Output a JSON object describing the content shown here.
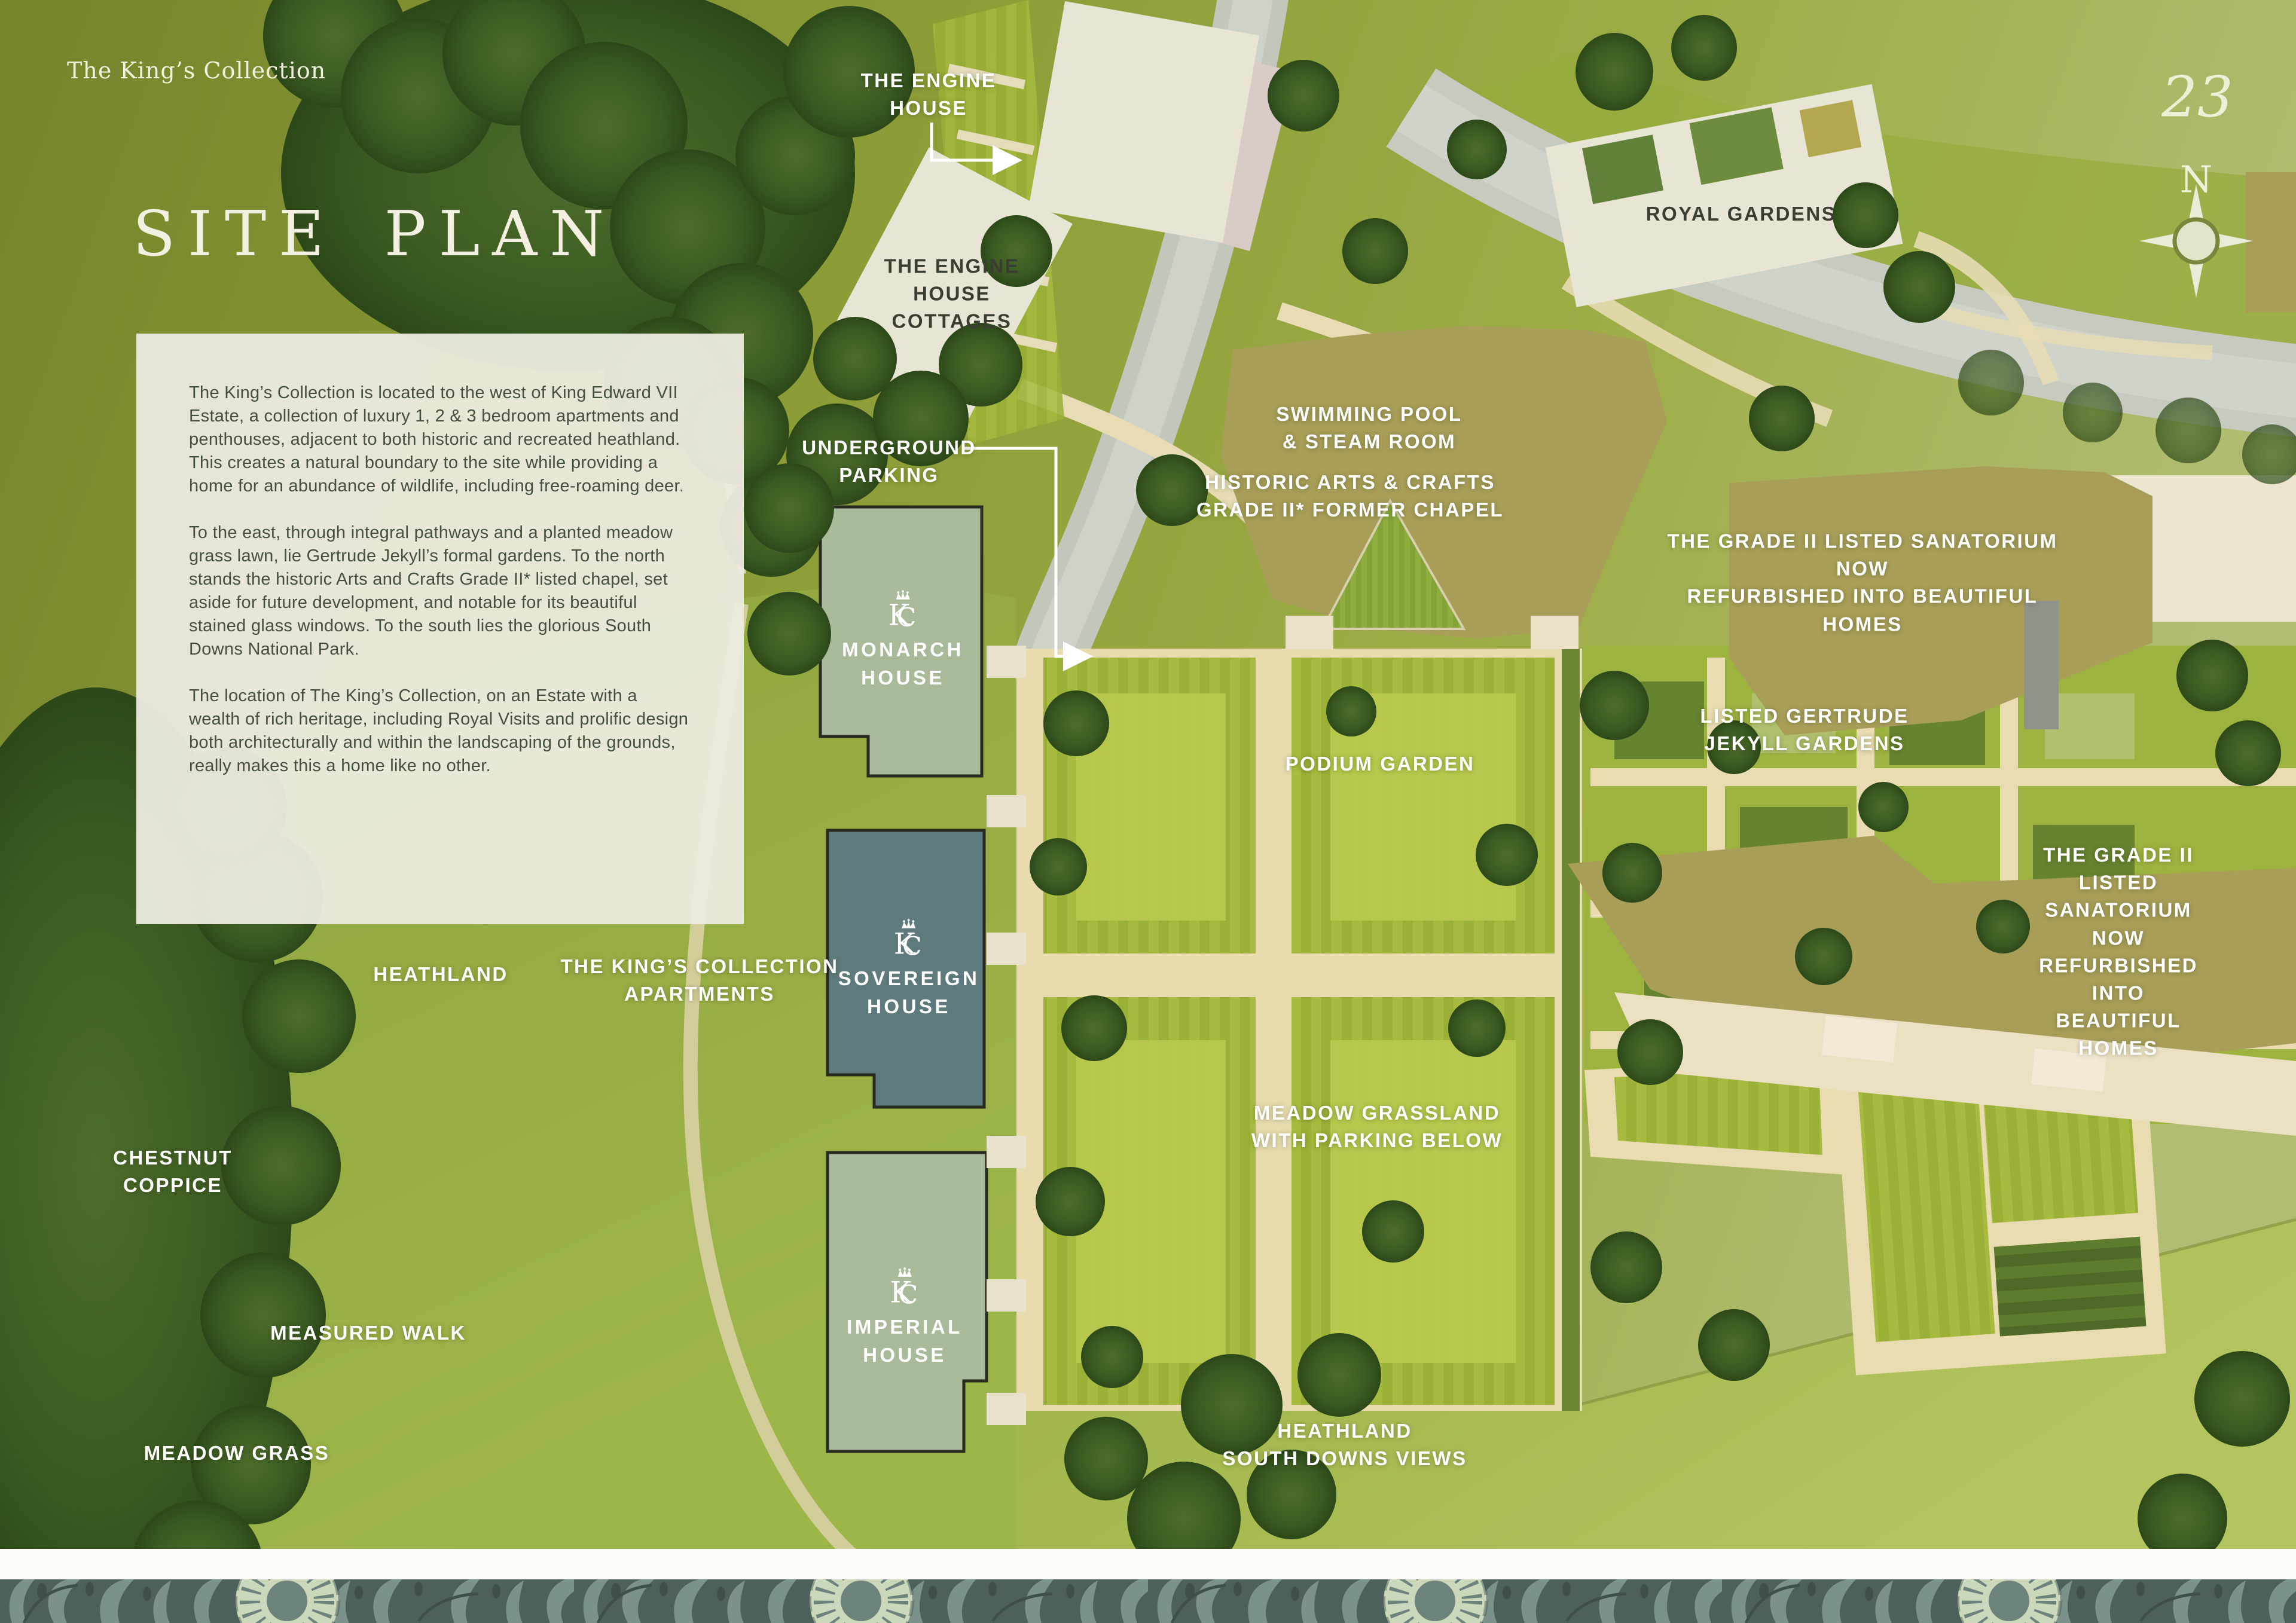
{
  "page": {
    "brand": "The King’s Collection",
    "title": "SITE PLAN",
    "page_number": "23",
    "compass": "N"
  },
  "intro": {
    "p1": "The King’s Collection is located to the west of King Edward VII Estate, a collection of luxury 1, 2 & 3 bedroom apartments and penthouses, adjacent to both historic and recreated heathland. This creates a natural boundary to the site while providing a home for an abundance of wildlife, including free-roaming deer.",
    "p2": "To the east, through integral pathways and a planted meadow grass lawn, lie Gertrude Jekyll’s formal gardens. To the north stands the historic Arts and Crafts Grade II* listed chapel, set aside for future development, and notable for its beautiful stained glass windows. To the south lies the glorious South Downs National Park.",
    "p3": "The location of The King’s Collection, on an Estate with a wealth of rich heritage, including Royal Visits and prolific design both architecturally and within the landscaping of the grounds, really makes this a home like no other."
  },
  "labels": {
    "engine_house": "THE ENGINE\nHOUSE",
    "engine_house_cottages": "THE ENGINE\nHOUSE\nCOTTAGES",
    "royal_gardens": "ROYAL GARDENS",
    "underground_parking": "UNDERGROUND\nPARKING",
    "swimming_pool": "SWIMMING POOL\n& STEAM ROOM",
    "former_chapel": "HISTORIC ARTS & CRAFTS\nGRADE II* FORMER CHAPEL",
    "sanatorium_north": "THE GRADE II LISTED SANATORIUM NOW\nREFURBISHED INTO BEAUTIFUL HOMES",
    "jekyll_gardens": "LISTED GERTRUDE\nJEKYLL GARDENS",
    "sanatorium_east": "THE GRADE II LISTED SANATORIUM NOW\nREFURBISHED INTO BEAUTIFUL HOMES",
    "podium_garden": "PODIUM GARDEN",
    "meadow_grassland": "MEADOW GRASSLAND\nWITH PARKING BELOW",
    "heathland": "HEATHLAND",
    "kings_collection_apartments": "THE KING’S COLLECTION\nAPARTMENTS",
    "chestnut_coppice": "CHESTNUT\nCOPPICE",
    "measured_walk": "MEASURED WALK",
    "meadow_grass": "MEADOW GRASS",
    "heathland_south_downs": "HEATHLAND\nSOUTH DOWNS VIEWS"
  },
  "houses": {
    "monarch": "MONARCH\nHOUSE",
    "sovereign": "SOVEREIGN\nHOUSE",
    "imperial": "IMPERIAL\nHOUSE"
  },
  "colors": {
    "backdrop_olive": "#8a9a35",
    "building_cream": "#e9e5d4",
    "building_sage": "#a9ba9b",
    "building_teal": "#5e7a7c",
    "building_olive": "#a89e58",
    "road_grey": "#c2c7bc",
    "path_cream": "#e8dcae",
    "footer_teal": "#4e605a",
    "label_white": "#ffffff",
    "label_dark": "#3a3d31"
  }
}
